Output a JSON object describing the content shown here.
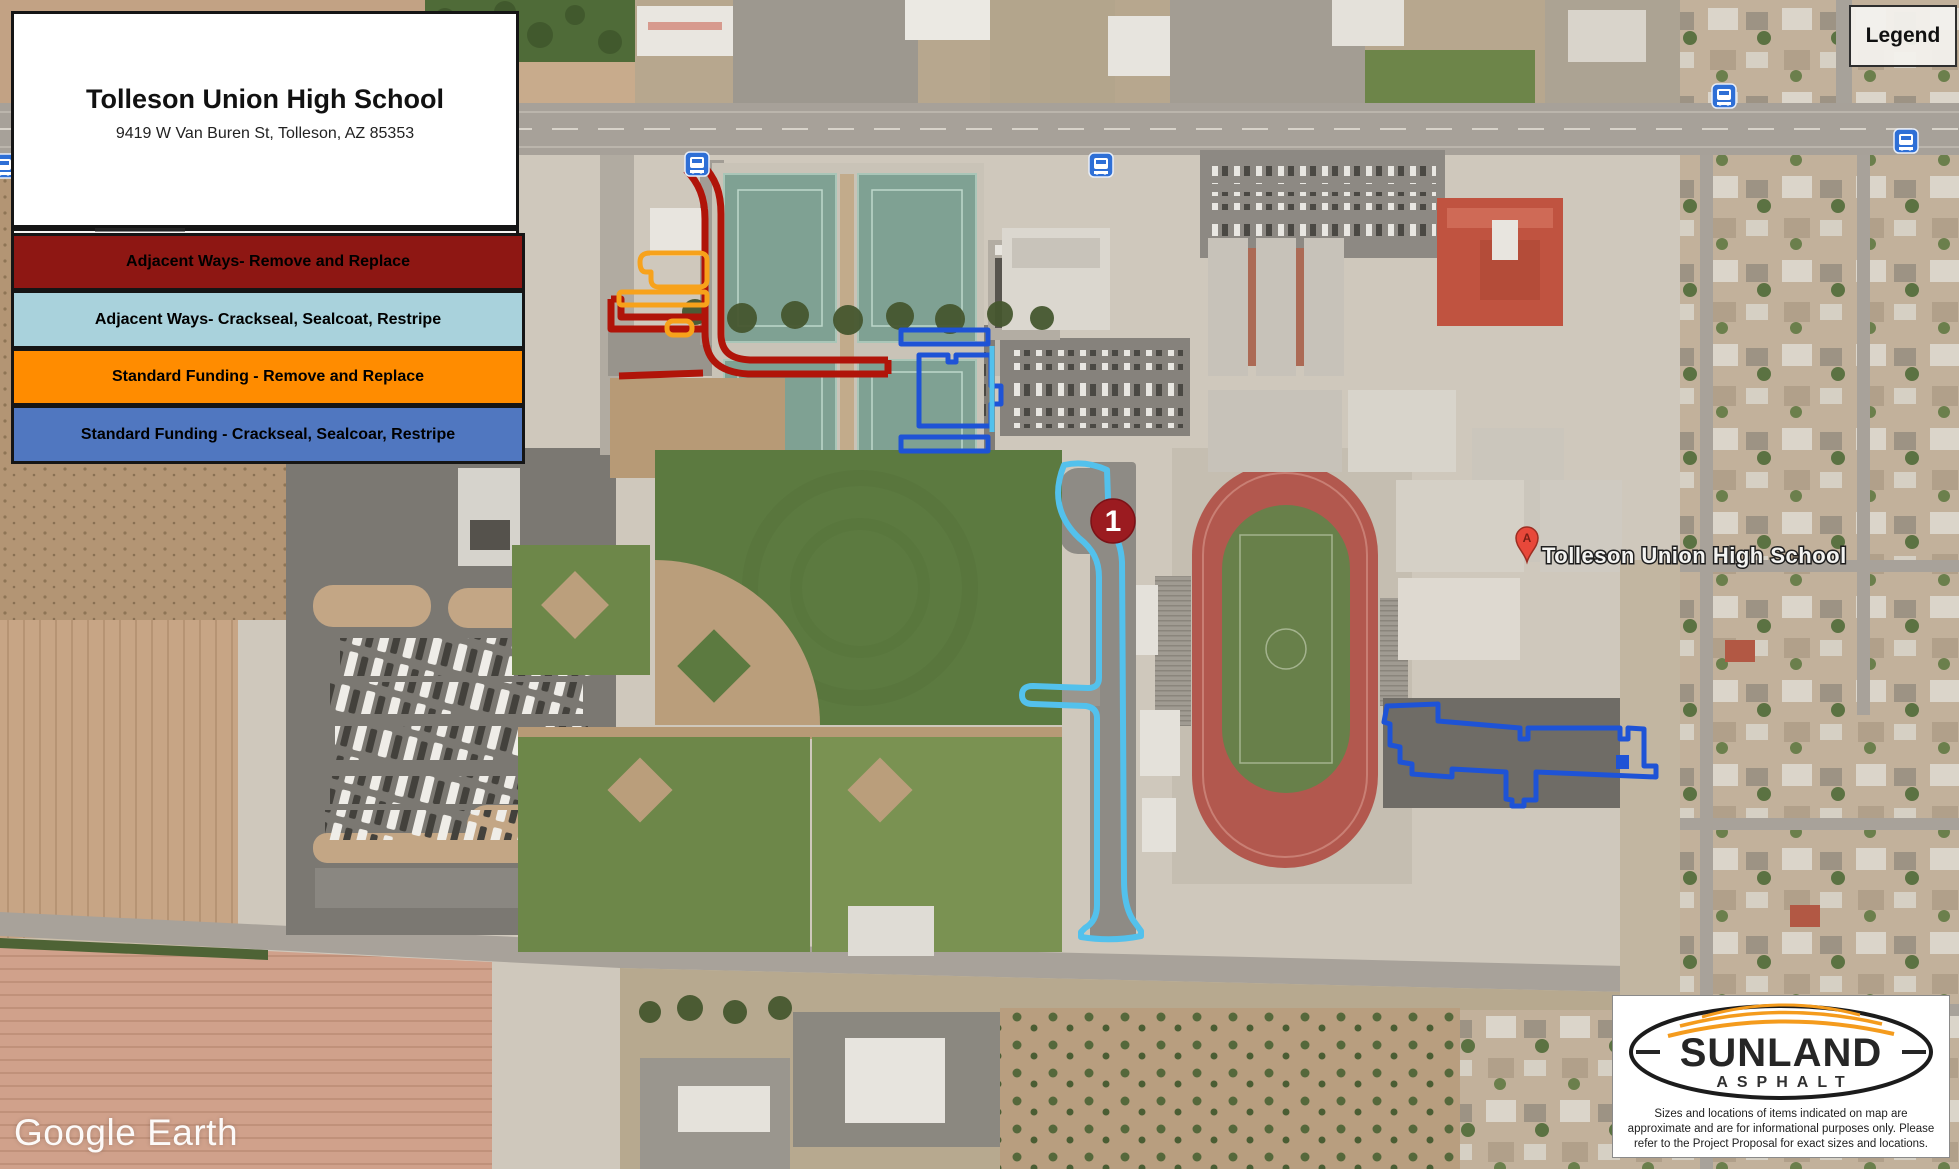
{
  "info_panel": {
    "title": "Tolleson Union High School",
    "address": "9419 W Van Buren St, Tolleson, AZ 85353"
  },
  "legend_panel": {
    "items": [
      {
        "label": "Adjacent Ways- Remove and Replace",
        "color": "#8e1713"
      },
      {
        "label": "Adjacent Ways- Crackseal, Sealcoat, Restripe",
        "color": "#a9d2dc"
      },
      {
        "label": "Standard Funding - Remove and Replace",
        "color": "#ff8c00"
      },
      {
        "label": "Standard Funding - Crackseal, Sealcoar, Restripe",
        "color": "#5077c0"
      }
    ]
  },
  "legend_box": {
    "title": "Legend"
  },
  "map": {
    "place_label": "Tolleson Union High School",
    "pin_letter": "A",
    "marker_number": "1",
    "watermark": "Google Earth"
  },
  "annotation_colors": {
    "adjacent_remove_replace": "#b01409",
    "adjacent_crackseal": "#53c1ec",
    "standard_remove_replace": "#f7a21b",
    "standard_crackseal": "#1e53d6",
    "marker_fill": "#9b1b20",
    "bus_icon": "#2e6fd6",
    "pin_fill": "#e8483a"
  },
  "sunland_box": {
    "brand": "SUNLAND",
    "brand_sub": "ASPHALT",
    "disclaimer": "Sizes and locations of items indicated on map are approximate and are for informational purposes only. Please refer to the Project Proposal for exact sizes and locations."
  }
}
